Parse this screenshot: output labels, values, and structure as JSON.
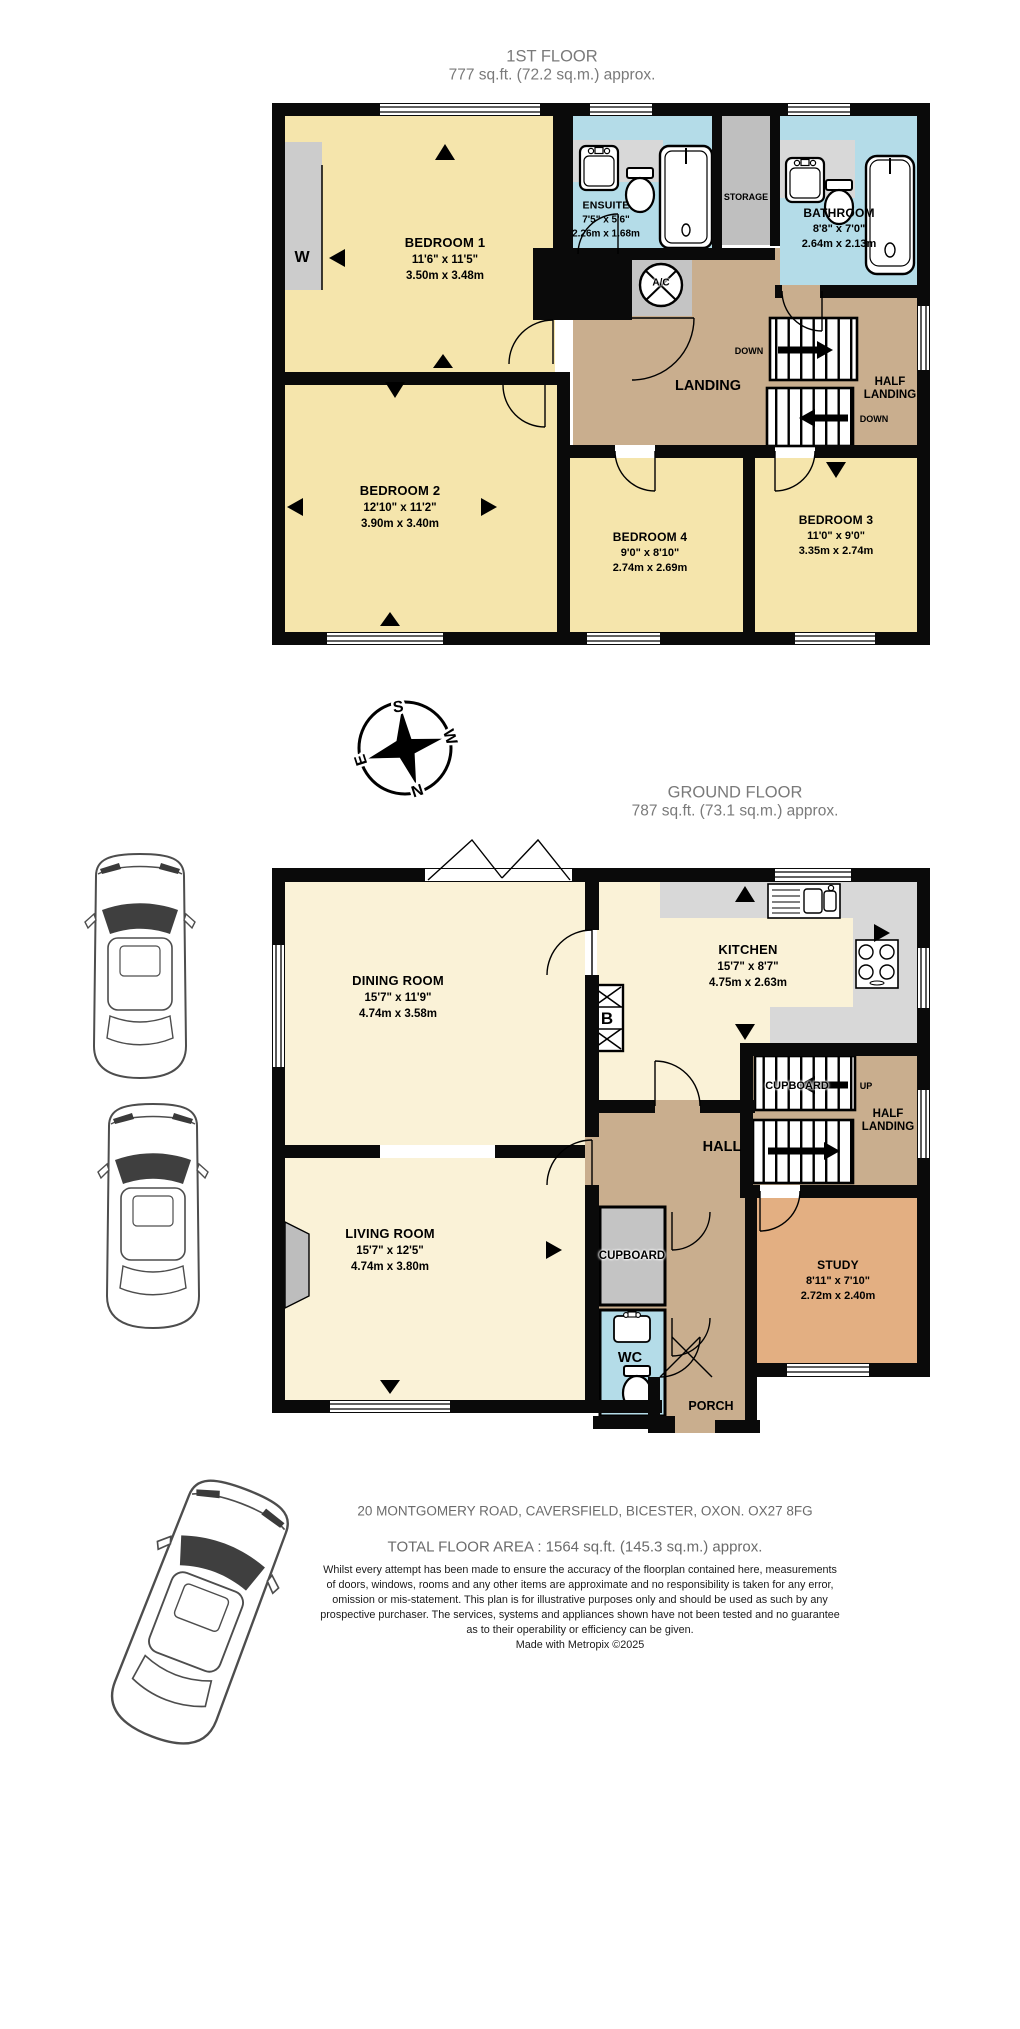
{
  "palette": {
    "wall": "#0a0a0a",
    "bedroom_yellow": "#f5e5ac",
    "ground_cream": "#faf2d7",
    "wet_blue": "#b4dce8",
    "landing_tan": "#c9ae8e",
    "study_orange": "#e3af82",
    "storage_gray": "#bfbfbf",
    "counter_gray": "#d8d8d8",
    "title_gray": "#7a7a7a"
  },
  "first_floor": {
    "title": "1ST FLOOR",
    "subtitle": "777 sq.ft. (72.2 sq.m.) approx.",
    "rooms": {
      "bedroom1": {
        "name": "BEDROOM 1",
        "imperial": "11'6\" x 11'5\"",
        "metric": "3.50m x 3.48m"
      },
      "bedroom2": {
        "name": "BEDROOM 2",
        "imperial": "12'10\" x 11'2\"",
        "metric": "3.90m x 3.40m"
      },
      "bedroom3": {
        "name": "BEDROOM 3",
        "imperial": "11'0\" x 9'0\"",
        "metric": "3.35m x 2.74m"
      },
      "bedroom4": {
        "name": "BEDROOM 4",
        "imperial": "9'0\" x 8'10\"",
        "metric": "2.74m x 2.69m"
      },
      "ensuite": {
        "name": "ENSUITE",
        "imperial": "7'5\" x 5'6\"",
        "metric": "2.26m x 1.68m"
      },
      "bathroom": {
        "name": "BATHROOM",
        "imperial": "8'8\" x 7'0\"",
        "metric": "2.64m x 2.13m"
      }
    },
    "labels": {
      "wardrobe": "W",
      "storage": "STORAGE",
      "landing": "LANDING",
      "half_landing": "HALF LANDING",
      "ac_unit": "A/C",
      "down": "DOWN"
    }
  },
  "ground_floor": {
    "title": "GROUND FLOOR",
    "subtitle": "787 sq.ft. (73.1 sq.m.) approx.",
    "rooms": {
      "dining": {
        "name": "DINING ROOM",
        "imperial": "15'7\" x 11'9\"",
        "metric": "4.74m x 3.58m"
      },
      "kitchen": {
        "name": "KITCHEN",
        "imperial": "15'7\" x 8'7\"",
        "metric": "4.75m x 2.63m"
      },
      "living": {
        "name": "LIVING ROOM",
        "imperial": "15'7\" x 12'5\"",
        "metric": "4.74m x 3.80m"
      },
      "study": {
        "name": "STUDY",
        "imperial": "8'11\" x 7'10\"",
        "metric": "2.72m x 2.40m"
      }
    },
    "labels": {
      "hall": "HALL",
      "half_landing": "HALF LANDING",
      "cupboard": "CUPBOARD",
      "understairs_cupboard": "CUPBOARD",
      "wc": "WC",
      "porch": "PORCH",
      "up": "UP",
      "boiler": "B"
    }
  },
  "compass": {
    "north": "N",
    "south": "S",
    "east": "E",
    "west": "W"
  },
  "footer": {
    "address": "20 MONTGOMERY ROAD, CAVERSFIELD, BICESTER, OXON. OX27 8FG",
    "total_area": "TOTAL FLOOR AREA : 1564 sq.ft. (145.3 sq.m.) approx.",
    "disclaimer": [
      "Whilst every attempt has been made to ensure the accuracy of the floorplan contained here, measurements",
      "of doors, windows, rooms and any other items are approximate and no responsibility is taken for any error,",
      "omission or mis-statement. This plan is for illustrative purposes only and should be used as such by any",
      "prospective purchaser. The services, systems and appliances shown have not been tested and no guarantee",
      "as to their operability or efficiency can be given."
    ],
    "credit": "Made with Metropix ©2025"
  }
}
